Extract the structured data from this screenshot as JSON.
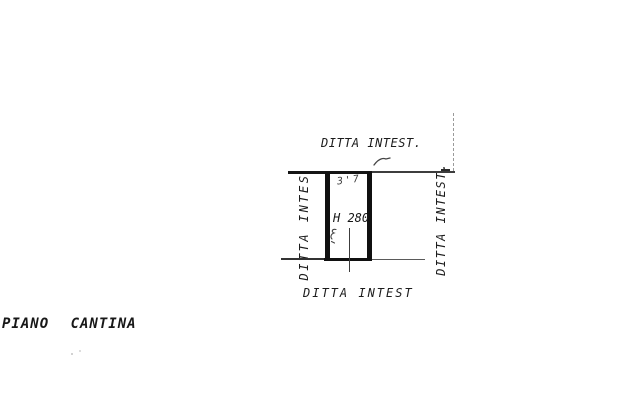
{
  "drawing": {
    "floor_label": "PIANO CANTINA",
    "room": {
      "height_label": "H 280",
      "pencil_dimension": "3'7"
    },
    "owner_labels": {
      "top": "DITTA INTEST.",
      "bottom": "DITTA INTEST",
      "left": "DITTA INTES",
      "right": "DITTA INTEST."
    },
    "colors": {
      "paper": "#ffffff",
      "ink": "#1c1c1c",
      "pencil": "#3a3a3a",
      "faint_line": "#9a9a9a"
    }
  }
}
